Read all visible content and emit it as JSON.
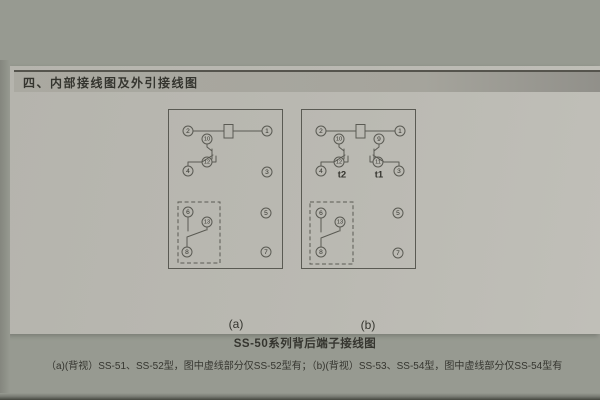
{
  "header": {
    "title": "四、内部接线图及外引接线图"
  },
  "caption": "SS-50系列背后端子接线图",
  "description": "（a)(背视）SS-51、SS-52型，图中虚线部分仅SS-52型有；（b)(背视）SS-53、SS-54型，图中虚线部分仅SS-54型有",
  "colors": {
    "bg": "#979a91",
    "page": "#b5b4ad",
    "band": "#a5a49c",
    "ink": "#35352f",
    "line": "#5a5a53"
  },
  "diagram_a": {
    "label": "(a)",
    "terminals": [
      {
        "n": "2",
        "x": 20,
        "y": 22
      },
      {
        "n": "1",
        "x": 99,
        "y": 22
      },
      {
        "n": "10",
        "x": 39,
        "y": 30
      },
      {
        "n": "12",
        "x": 39,
        "y": 53
      },
      {
        "n": "4",
        "x": 20,
        "y": 62
      },
      {
        "n": "3",
        "x": 99,
        "y": 63
      },
      {
        "n": "6",
        "x": 20,
        "y": 103
      },
      {
        "n": "13",
        "x": 39,
        "y": 113
      },
      {
        "n": "5",
        "x": 98,
        "y": 104
      },
      {
        "n": "8",
        "x": 19,
        "y": 143
      },
      {
        "n": "7",
        "x": 98,
        "y": 143
      }
    ],
    "tags": []
  },
  "diagram_b": {
    "label": "(b)",
    "terminals": [
      {
        "n": "2",
        "x": 20,
        "y": 22
      },
      {
        "n": "1",
        "x": 99,
        "y": 22
      },
      {
        "n": "10",
        "x": 38,
        "y": 30
      },
      {
        "n": "9",
        "x": 78,
        "y": 30
      },
      {
        "n": "12",
        "x": 38,
        "y": 53
      },
      {
        "n": "11",
        "x": 77,
        "y": 53
      },
      {
        "n": "4",
        "x": 20,
        "y": 62
      },
      {
        "n": "3",
        "x": 98,
        "y": 62
      },
      {
        "n": "6",
        "x": 20,
        "y": 104
      },
      {
        "n": "13",
        "x": 39,
        "y": 113
      },
      {
        "n": "5",
        "x": 97,
        "y": 104
      },
      {
        "n": "8",
        "x": 20,
        "y": 143
      },
      {
        "n": "7",
        "x": 97,
        "y": 144
      }
    ],
    "tags": [
      {
        "text": "t2",
        "x": 41,
        "y": 66
      },
      {
        "text": "t1",
        "x": 78,
        "y": 66
      }
    ]
  }
}
